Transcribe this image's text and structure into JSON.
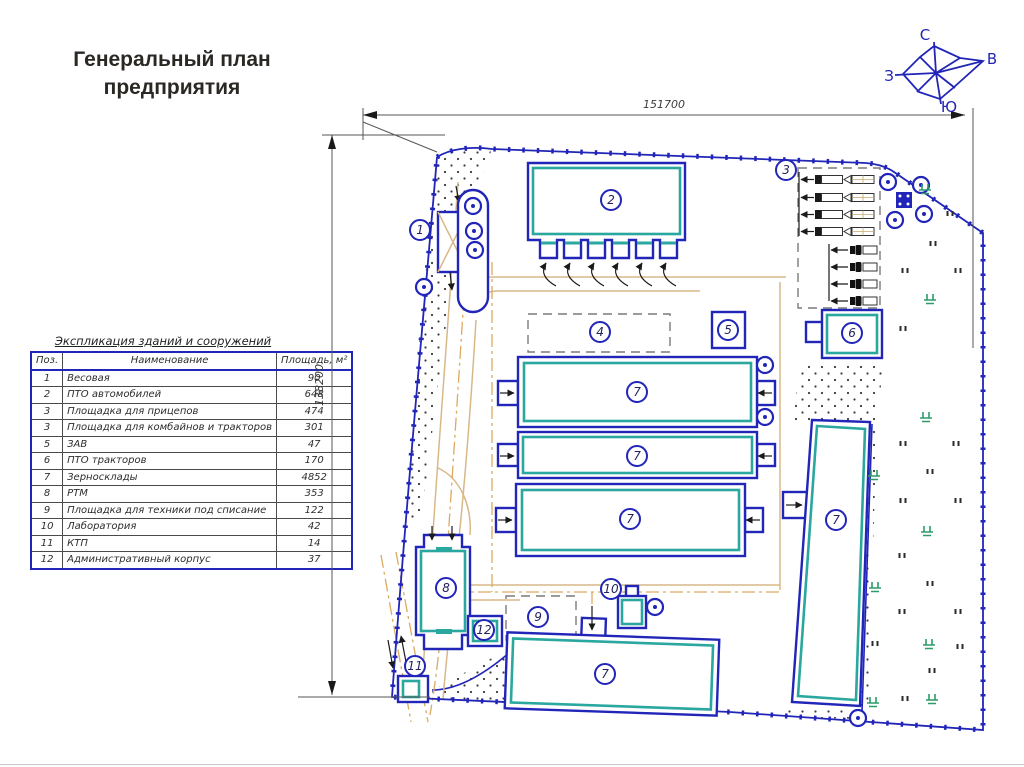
{
  "title": "Генеральный план предприятия",
  "compass": {
    "north": "С",
    "east": "В",
    "south": "Ю",
    "west": "З"
  },
  "dimensions": {
    "top": "151700",
    "left": "138200"
  },
  "explication": {
    "title": "Экспликация зданий и сооружений",
    "headers": [
      "Поз.",
      "Наименование",
      "Площадь, м²"
    ],
    "rows": [
      [
        "1",
        "Весовая",
        "90"
      ],
      [
        "2",
        "ПТО автомобилей",
        "648"
      ],
      [
        "3",
        "Площадка для прицепов",
        "474"
      ],
      [
        "3",
        "Площадка для комбайнов и тракторов",
        "301"
      ],
      [
        "5",
        "ЗАВ",
        "47"
      ],
      [
        "6",
        "ПТО тракторов",
        "170"
      ],
      [
        "7",
        "Зерносклады",
        "4852"
      ],
      [
        "8",
        "РТМ",
        "353"
      ],
      [
        "9",
        "Площадка для техники под списание",
        "122"
      ],
      [
        "10",
        "Лаборатория",
        "42"
      ],
      [
        "11",
        "КТП",
        "14"
      ],
      [
        "12",
        "Административный корпус",
        "37"
      ]
    ]
  },
  "markers": {
    "m1": "1",
    "m2": "2",
    "m3": "3",
    "m4": "4",
    "m5": "5",
    "m6": "6",
    "m7a": "7",
    "m7b": "7",
    "m7c": "7",
    "m7d": "7",
    "m7e": "7",
    "m8": "8",
    "m9": "9",
    "m10": "10",
    "m11": "11",
    "m12": "12"
  },
  "colors": {
    "plan_blue": "#2125b8",
    "teal": "#2aa79f",
    "road_tan": "#d9b888",
    "road_centerline": "#dcaa60",
    "vegetation_green": "#2c9c68",
    "title_text": "#2b2824"
  }
}
